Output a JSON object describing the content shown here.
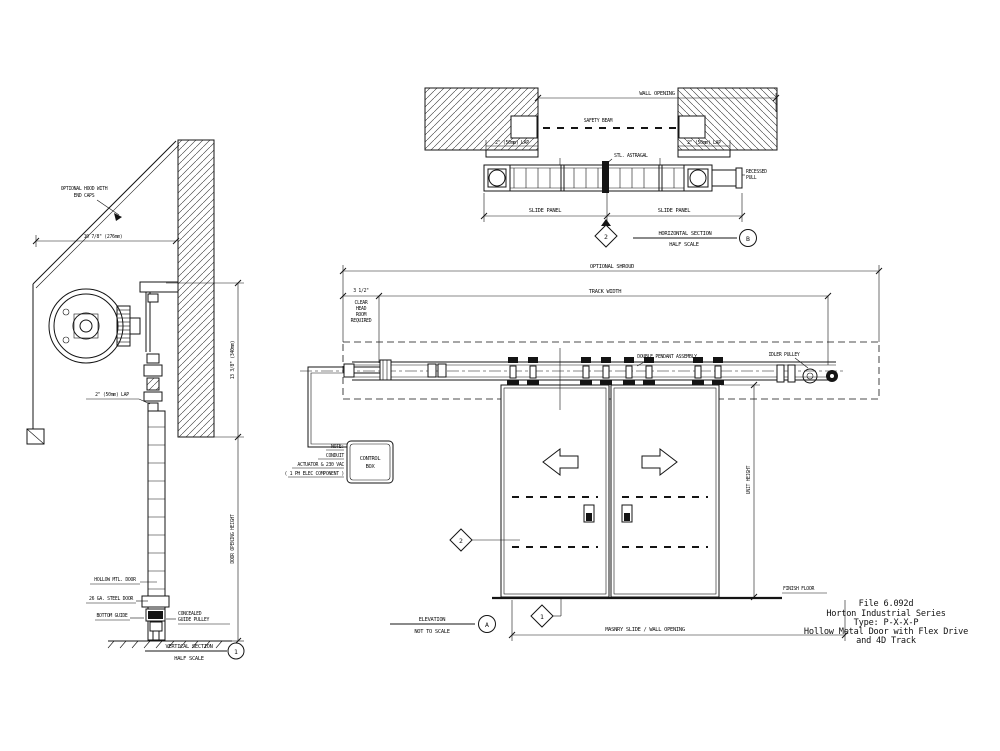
{
  "app": {
    "background": "#ffffff",
    "ink": "#141414"
  },
  "title_block": {
    "file": "File 6.092d",
    "series": "Horton Industrial Series",
    "type": "Type: P-X-X-P",
    "description": "Hollow Metal Door with Flex Drive",
    "description2": "and 4D Track"
  },
  "vertical_section": {
    "hood_note_l1": "OPTIONAL HOOD WITH",
    "hood_note_l2": "END CAPS",
    "hood_dim": "10 7/8\" (276mm)",
    "headroom_dim": "13 3/8\" (340mm)",
    "opening_dim": "DOOR OPENING HEIGHT",
    "lap_note": "2\" (50mm) LAP",
    "door_label": "HOLLOW MTL. DOOR",
    "steel_label": "26 GA. STEEL DOOR",
    "guide_label": "BOTTOM GUIDE",
    "pulley_l1": "CONCEALED",
    "pulley_l2": "GUIDE PULLEY",
    "caption": "VERTICAL SECTION",
    "scale": "HALF SCALE",
    "ref": "1"
  },
  "horizontal_section": {
    "wall_opening_dim": "WALL OPENING",
    "safety_beam": "SAFETY BEAM",
    "lap_left": "2\" (50mm) LAP",
    "lap_right": "2\" (50mm) LAP",
    "astragal": "STL. ASTRAGAL",
    "pull_l1": "RECESSED",
    "pull_l2": "PULL",
    "slide_left": "SLIDE PANEL",
    "slide_right": "SLIDE PANEL",
    "marker": "2",
    "caption": "HORIZONTAL SECTION",
    "scale": "HALF SCALE",
    "ref": "B"
  },
  "elevation": {
    "shroud_dim": "OPTIONAL SHROUD",
    "track_dim": "TRACK WIDTH",
    "clear_dim": "3 1/2\"",
    "clear_l1": "CLEAR",
    "clear_l2": "HEAD",
    "clear_l3": "ROOM",
    "clear_l4": "REQUIRED",
    "pendant_label": "DOUBLE PENDANT ASSEMBLY",
    "idler_label": "IDLER PULLEY",
    "note_l1": "NOTE:",
    "note_l2": "CONDUIT",
    "note_l3": "ACTUATOR & 230 VAC",
    "note_l4": "( 1 PH ELEC COMPONENT )",
    "control_l1": "CONTROL",
    "control_l2": "BOX",
    "unit_height_dim": "UNIT HEIGHT",
    "finish_floor": "FINISH FLOOR",
    "masonry_dim": "MASNRY SLIDE / WALL OPENING",
    "marker_cut2": "2",
    "marker_cut1": "1",
    "caption": "ELEVATION",
    "scale": "NOT TO SCALE",
    "ref": "A"
  }
}
